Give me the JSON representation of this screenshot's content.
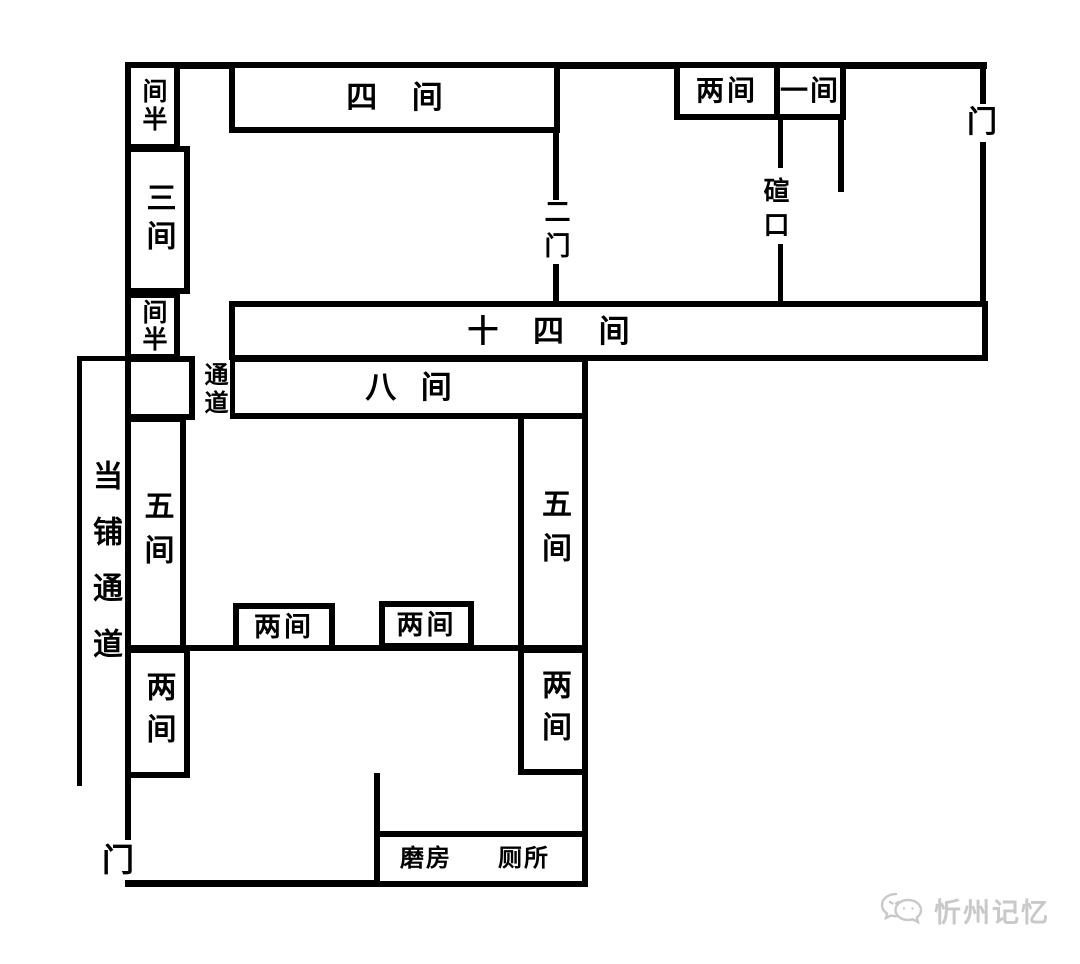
{
  "colors": {
    "line": "#000000",
    "background": "#ffffff",
    "watermark": "#c9c9c9"
  },
  "rooms": {
    "jianban_top": "间半",
    "sanjian": "三间",
    "jianban_mid": "间半",
    "sijian": "四 间",
    "liangjian_top": "两间",
    "yijian": "一间",
    "shisijian": "十 四 间",
    "bajian": "八 间",
    "wujian_left": "五间",
    "wujian_right": "五间",
    "liangjian_left": "两间",
    "liangjian_right": "两间",
    "liangjian_small_1": "两间",
    "liangjian_small_2": "两间",
    "mofang": "磨房",
    "cesuo": "厕所"
  },
  "passages": {
    "tongdao": "通道",
    "dangpu_tongdao": "当铺通道",
    "ermen": "二门",
    "xuankou": "碹口"
  },
  "doors": {
    "men_top_right": "门",
    "men_bottom_left": "门"
  },
  "watermark": {
    "text": "忻州记忆"
  }
}
